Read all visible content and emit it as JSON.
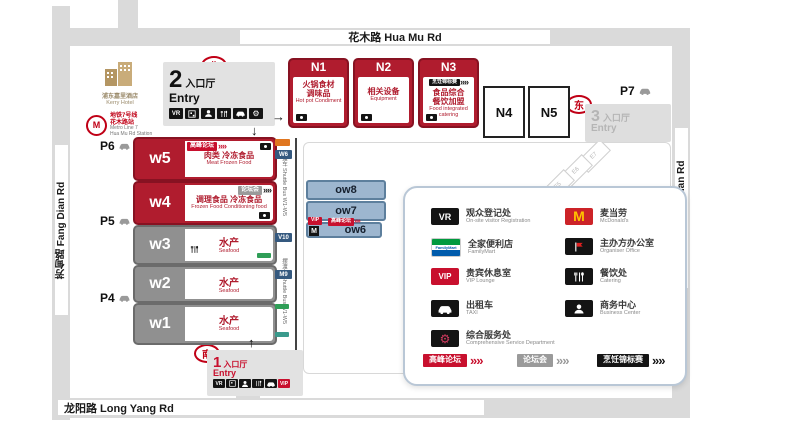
{
  "roads": {
    "top": "花木路 Hua Mu Rd",
    "bottom": "龙阳路 Long Yang Rd",
    "left": "芳甸路 Fang Dian Rd",
    "right": "罗山路 Luo Shan Rd"
  },
  "compass": {
    "north": "北",
    "south": "南",
    "east": "东"
  },
  "landmarks": {
    "hotel": {
      "zh": "浦东嘉里酒店",
      "en": "Kerry Hotel"
    },
    "metro": {
      "zh1": "地铁7号线",
      "zh2": "花木路站",
      "en1": "Metro Line 7",
      "en2": "Hua Mu Rd Station"
    }
  },
  "parking": {
    "p6": "P6",
    "p5": "P5",
    "p4": "P4",
    "p7": "P7"
  },
  "entries": {
    "e2": {
      "num": "2",
      "zh": "入口厅",
      "en": "Entry"
    },
    "e1": {
      "num": "1",
      "zh": "入口厅",
      "en": "Entry"
    },
    "e3": {
      "num": "3",
      "zh": "入口厅",
      "en": "Entry"
    }
  },
  "halls_n": {
    "n1": {
      "id": "N1",
      "zh1": "火锅食材",
      "zh2": "调味品",
      "en": "Hot pot Condiment"
    },
    "n2": {
      "id": "N2",
      "zh1": "相关设备",
      "zh2": "",
      "en": "Equipment"
    },
    "n3": {
      "id": "N3",
      "badge": "烹饪锦标赛",
      "zh1": "食品综合",
      "zh2": "餐饮加盟",
      "en": "Food integrated catering"
    },
    "n4": {
      "id": "N4"
    },
    "n5": {
      "id": "N5"
    }
  },
  "halls_w": {
    "w5": {
      "id": "w5",
      "badge": "高峰论坛",
      "zh1": "肉类",
      "zh2": "冷冻食品",
      "en": "Meat Frozen Food"
    },
    "w4": {
      "id": "w4",
      "badge": "论坛会",
      "zh1": "调理食品",
      "zh2": "冷冻食品",
      "en": "Frozen Food Conditioning food"
    },
    "w3": {
      "id": "w3",
      "zh": "水产",
      "en": "Seafood"
    },
    "w2": {
      "id": "w2",
      "zh": "水产",
      "en": "Seafood"
    },
    "w1": {
      "id": "w1",
      "zh": "水产",
      "en": "Seafood"
    }
  },
  "halls_ow": {
    "ow8": "ow8",
    "ow7": "ow7",
    "ow6": "ow6",
    "ow6_vip": "VIP",
    "ow6_m": "M",
    "ow6_banner": "高峰论坛"
  },
  "shuttle": {
    "label": "摆渡车 Shuttle Bus W1-W5",
    "stops": [
      "W6",
      "V10",
      "M9"
    ]
  },
  "e_halls": [
    "E7",
    "E6",
    "E5"
  ],
  "legend": {
    "left": [
      {
        "icon": "vr-icon",
        "zh": "观众登记处",
        "en": "On-site visitor Registration"
      },
      {
        "icon": "familymart-icon",
        "zh": "全家便利店",
        "en": "FamilyMart"
      },
      {
        "icon": "vip-icon",
        "zh": "贵宾休息室",
        "en": "VIP Lounge"
      },
      {
        "icon": "taxi-icon",
        "zh": "出租车",
        "en": "TAXI"
      },
      {
        "icon": "gear-icon",
        "zh": "综合服务处",
        "en": "Comprehensive Service Department"
      }
    ],
    "right": [
      {
        "icon": "mcdonalds-icon",
        "zh": "麦当劳",
        "en": "McDonald's"
      },
      {
        "icon": "flag-icon",
        "zh": "主办方办公室",
        "en": "Organiser Office"
      },
      {
        "icon": "utensils-icon",
        "zh": "餐饮处",
        "en": "Catering"
      },
      {
        "icon": "person-icon",
        "zh": "商务中心",
        "en": "Business Center"
      }
    ],
    "badges": [
      {
        "text": "高峰论坛",
        "color": "#c8102e"
      },
      {
        "text": "论坛会",
        "color": "#9a9a9a"
      },
      {
        "text": "烹饪锦标赛",
        "color": "#141414"
      }
    ]
  },
  "chips": {
    "vr": "VR",
    "vip": "VIP",
    "fm": "FamilyMart",
    "mcd": "M"
  },
  "ui": {
    "chevrons": "»»",
    "arrow_up": "↑",
    "arrow_down": "↓",
    "arrow_right": "→",
    "gear_glyph": "⚙"
  },
  "colors": {
    "hall_red": "#b01c2e",
    "hall_gray": "#909090",
    "ow_blue": "#9db6cf",
    "road": "#dadada",
    "accent_red": "#c8102e"
  }
}
